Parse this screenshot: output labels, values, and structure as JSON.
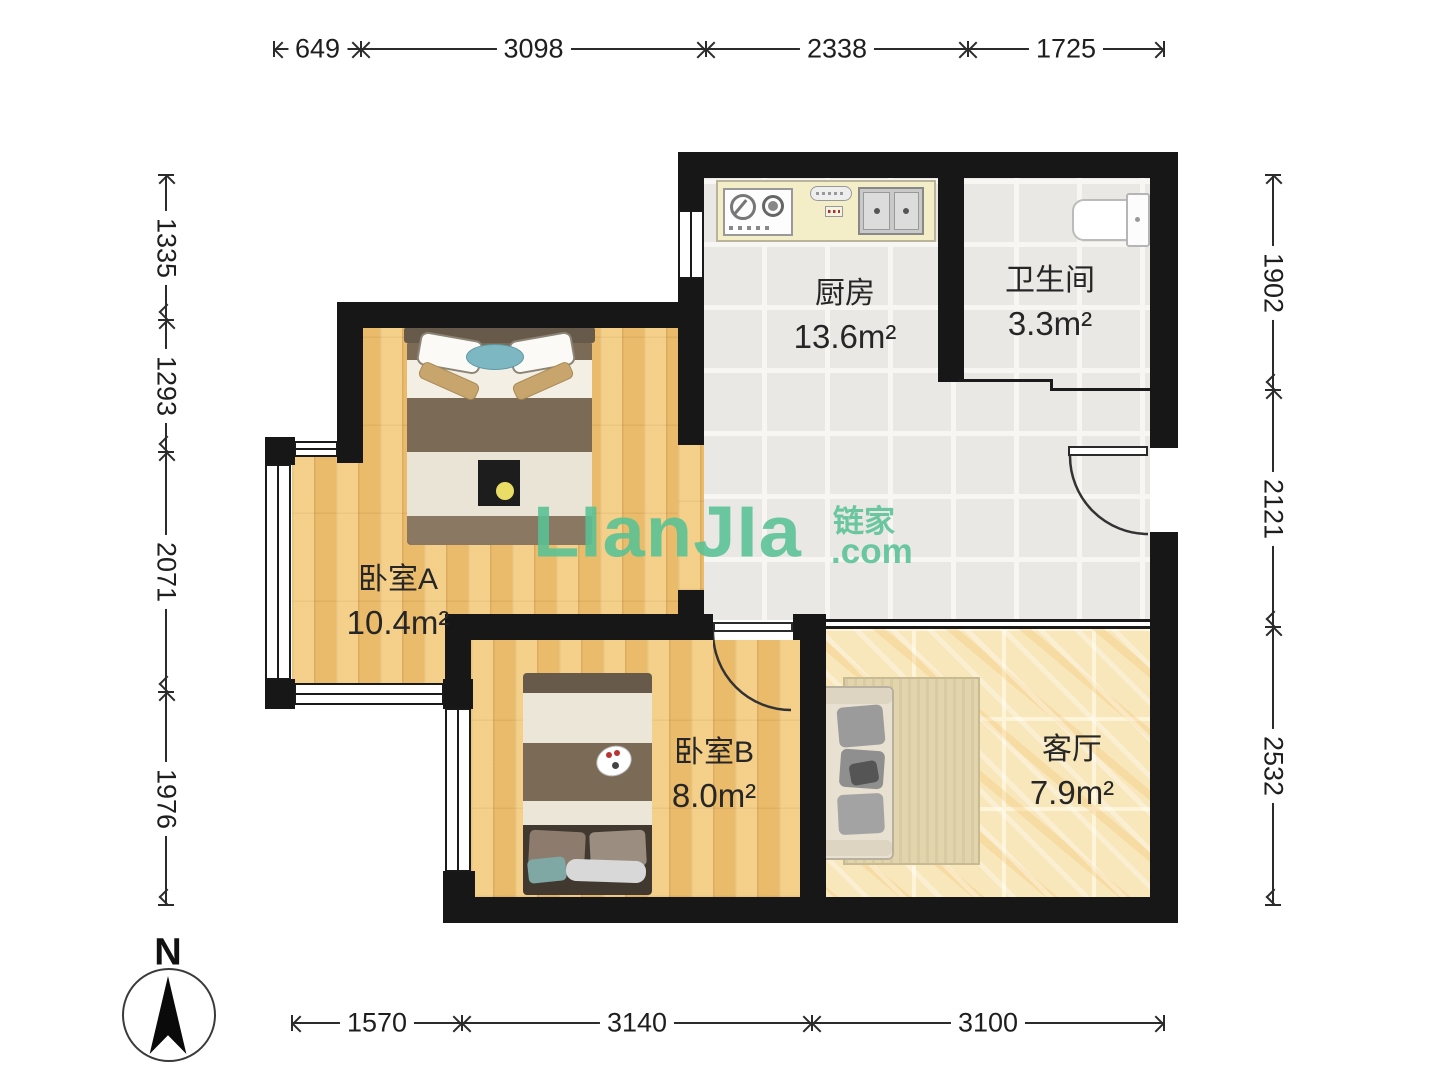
{
  "watermark": {
    "main": "LIanJIa",
    "cn": "链家",
    "com": ".com",
    "color": "#58c295"
  },
  "compass": {
    "label": "N"
  },
  "rooms": {
    "kitchen": {
      "name": "厨房",
      "area": "13.6m²"
    },
    "bathroom": {
      "name": "卫生间",
      "area": "3.3m²"
    },
    "bedroom_a": {
      "name": "卧室A",
      "area": "10.4m²"
    },
    "bedroom_b": {
      "name": "卧室B",
      "area": "8.0m²"
    },
    "living": {
      "name": "客厅",
      "area": "7.9m²"
    }
  },
  "dimensions_mm": {
    "top": {
      "pos": 34,
      "orientation": "h",
      "segments": [
        {
          "label": "649",
          "from": 274,
          "to": 361
        },
        {
          "label": "3098",
          "from": 361,
          "to": 706
        },
        {
          "label": "2338",
          "from": 706,
          "to": 968
        },
        {
          "label": "1725",
          "from": 968,
          "to": 1164
        }
      ]
    },
    "bottom": {
      "pos": 1008,
      "orientation": "h",
      "segments": [
        {
          "label": "1570",
          "from": 292,
          "to": 462
        },
        {
          "label": "3140",
          "from": 462,
          "to": 812
        },
        {
          "label": "3100",
          "from": 812,
          "to": 1164
        }
      ]
    },
    "left": {
      "pos": 151,
      "orientation": "v",
      "segments": [
        {
          "label": "1335",
          "from": 175,
          "to": 320
        },
        {
          "label": "1293",
          "from": 320,
          "to": 452
        },
        {
          "label": "2071",
          "from": 452,
          "to": 692
        },
        {
          "label": "1976",
          "from": 692,
          "to": 905
        }
      ]
    },
    "right": {
      "pos": 1258,
      "orientation": "v",
      "segments": [
        {
          "label": "1902",
          "from": 175,
          "to": 390
        },
        {
          "label": "2121",
          "from": 390,
          "to": 627
        },
        {
          "label": "2532",
          "from": 627,
          "to": 905
        }
      ]
    }
  },
  "colors": {
    "wall": "#171717",
    "wood_floor": "#efc373",
    "tile_floor": "#e9e8e4",
    "marble_floor": "#f8e7ba",
    "counter": "#f3eec8",
    "watermark_green": "#58c295"
  }
}
